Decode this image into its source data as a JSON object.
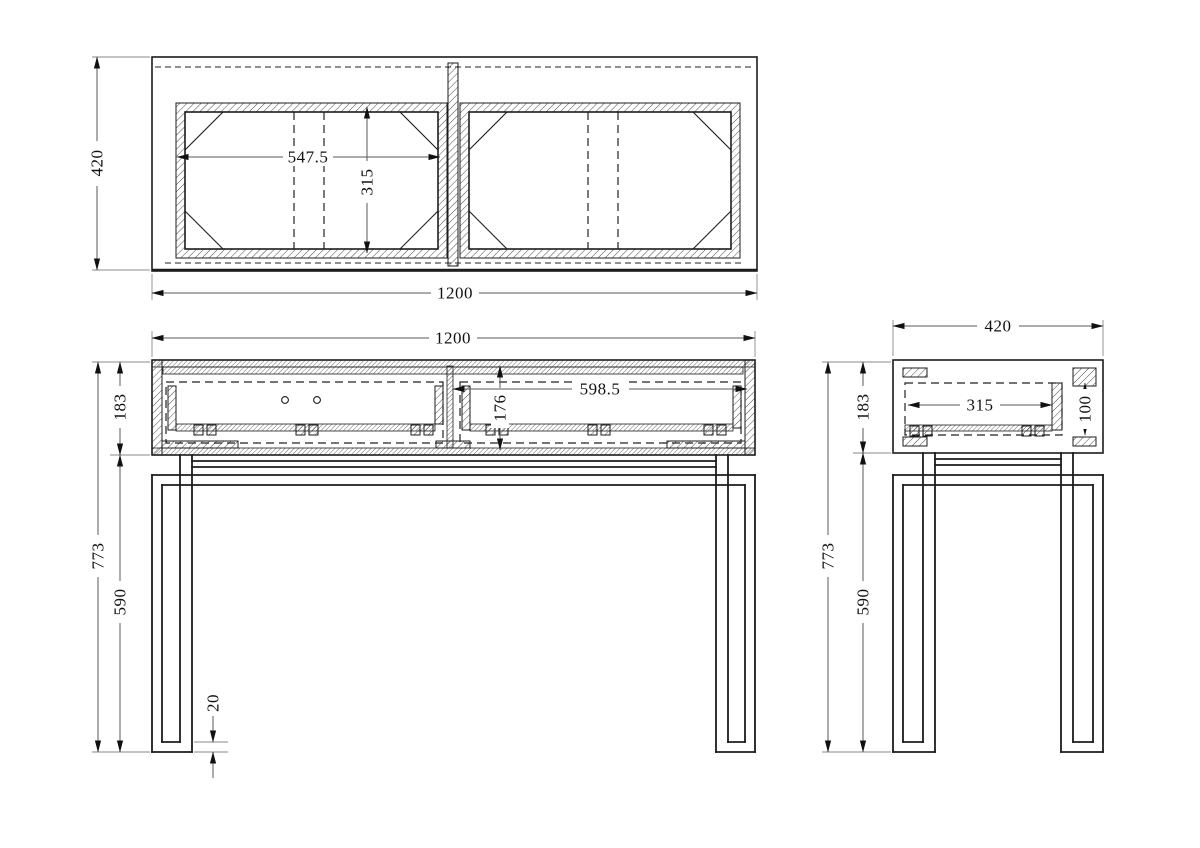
{
  "drawing": {
    "type": "furniture-technical-drawing",
    "units": "mm",
    "colors": {
      "ink": "#1c1c1c",
      "dim_line": "#5a5a5a",
      "dim_text": "#111111",
      "paper": "#ffffff"
    },
    "views": {
      "top": {
        "label": "top-view",
        "dims": {
          "depth": "420",
          "width": "1200",
          "drawer_width": "547.5",
          "drawer_depth": "315"
        }
      },
      "front": {
        "label": "front-view",
        "dims": {
          "width": "1200",
          "cabinet_height": "183",
          "total_height": "773",
          "leg_height": "590",
          "drawer_front_width": "598.5",
          "drawer_opening_height": "176",
          "foot_thickness": "20"
        }
      },
      "side": {
        "label": "side-view",
        "dims": {
          "depth": "420",
          "cabinet_height": "183",
          "total_height": "773",
          "leg_height": "590",
          "drawer_depth": "315",
          "drawer_inner_height": "100"
        }
      }
    }
  }
}
